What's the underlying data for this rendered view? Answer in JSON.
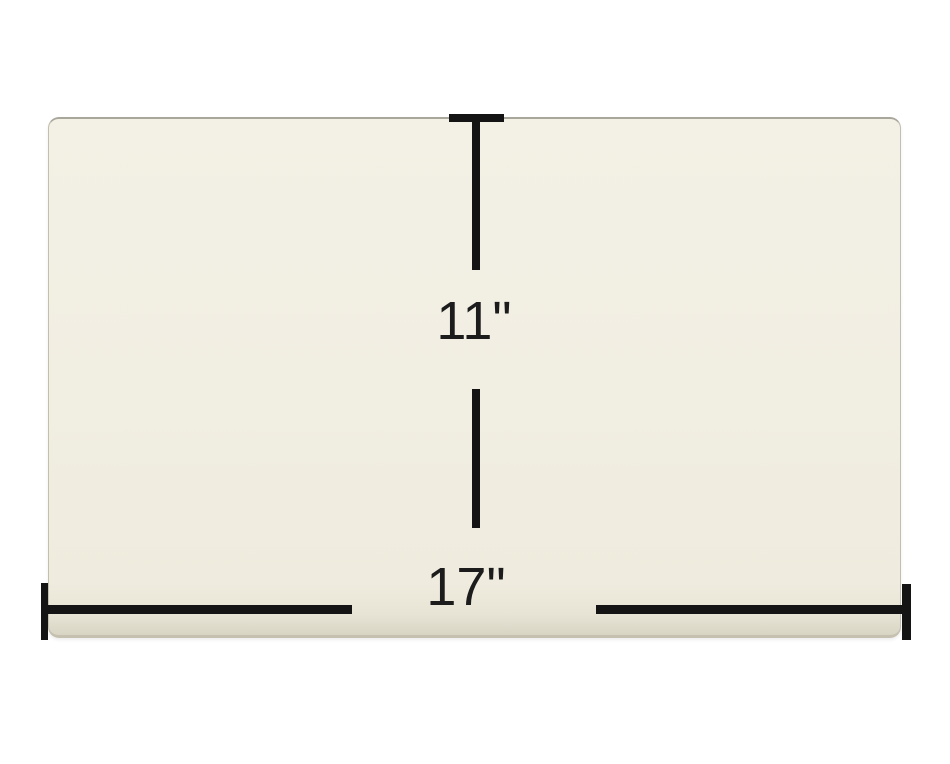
{
  "diagram": {
    "background_color": "#ffffff",
    "panel": {
      "fill_color": "#f1eee2",
      "edge_color": "#a9a69c"
    },
    "dimension_lines": {
      "color": "#141414"
    },
    "vertical_dimension": {
      "label": "11\""
    },
    "horizontal_dimension": {
      "label": "17\""
    }
  }
}
